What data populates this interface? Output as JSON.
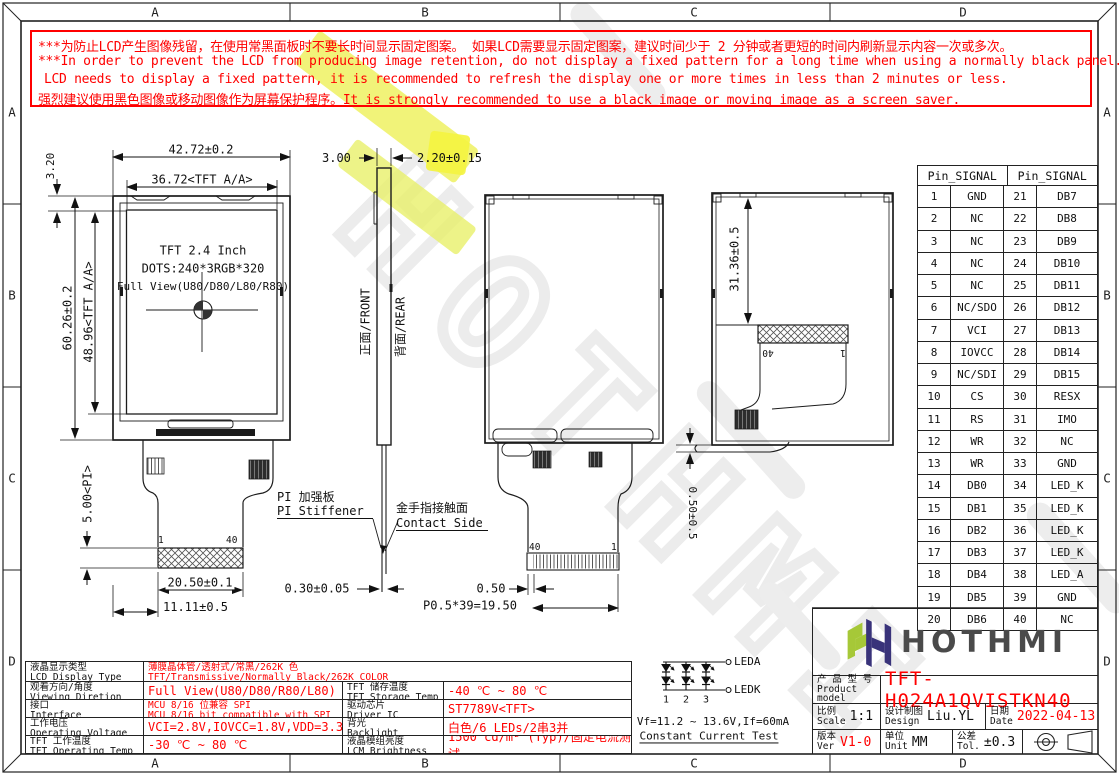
{
  "frame": {
    "zones": [
      "A",
      "B",
      "C",
      "D"
    ]
  },
  "warning": {
    "line1": "***为防止LCD产生图像残留，在使用常黑面板时不要长时间显示固定图案。 如果LCD需要显示固定图案，建议时间少于 2 分钟或者更短的时间内刷新显示内容一次或多次。",
    "line2": "***In order to prevent the LCD from producing image retention, do not display a fixed pattern for a long time when using a normally black panel. If the",
    "line3": "LCD needs to display a fixed pattern, it is recommended to refresh the display one or more times in less than 2 minutes or less.",
    "line4_zh": "强烈建议使用黑色图像或移动图像作为屏幕保护程序。",
    "line4_en": "It is strongly recommended to use a black image or moving image as a screen saver."
  },
  "fv": {
    "l1": "TFT 2.4 Inch",
    "l2": "DOTS:240*3RGB*320",
    "l3": "Full View(U80/D80/L80/R80)",
    "w": "42.72±0.2",
    "wa": "36.72<TFT A/A>",
    "off": "3.20",
    "h": "60.26±0.2",
    "ha": "48.96<TFT A/A>",
    "pi": "5.00<PI>",
    "cw": "20.50±0.1",
    "co": "11.11±0.5",
    "p1": "1",
    "p40": "40"
  },
  "sv": {
    "t1": "3.00",
    "t2": "2.20±0.15",
    "front": "正面/FRONT",
    "rear": "背面/REAR",
    "stiff_zh": "PI 加强板",
    "stiff_en": "PI Stiffener",
    "contact_zh": "金手指接触面",
    "contact_en": "Contact Side",
    "ft": "0.30±0.05",
    "fo": "0.50",
    "pitch": "P0.5*39=19.50",
    "p40": "40",
    "p1": "1"
  },
  "bv": {
    "cp": "31.36±0.5",
    "pr": "0.50±0.5",
    "p40": "40",
    "p1": "1"
  },
  "pin_table": {
    "header": "Pin_SIGNAL",
    "rows": [
      [
        "1",
        "GND",
        "21",
        "DB7"
      ],
      [
        "2",
        "NC",
        "22",
        "DB8"
      ],
      [
        "3",
        "NC",
        "23",
        "DB9"
      ],
      [
        "4",
        "NC",
        "24",
        "DB10"
      ],
      [
        "5",
        "NC",
        "25",
        "DB11"
      ],
      [
        "6",
        "NC/SDO",
        "26",
        "DB12"
      ],
      [
        "7",
        "VCI",
        "27",
        "DB13"
      ],
      [
        "8",
        "IOVCC",
        "28",
        "DB14"
      ],
      [
        "9",
        "NC/SDI",
        "29",
        "DB15"
      ],
      [
        "10",
        "CS",
        "30",
        "RESX"
      ],
      [
        "11",
        "RS",
        "31",
        "IMO"
      ],
      [
        "12",
        "WR",
        "32",
        "NC"
      ],
      [
        "13",
        "WR",
        "33",
        "GND"
      ],
      [
        "14",
        "DB0",
        "34",
        "LED_K"
      ],
      [
        "15",
        "DB1",
        "35",
        "LED_K"
      ],
      [
        "16",
        "DB2",
        "36",
        "LED_K"
      ],
      [
        "17",
        "DB3",
        "37",
        "LED_K"
      ],
      [
        "18",
        "DB4",
        "38",
        "LED_A"
      ],
      [
        "19",
        "DB5",
        "39",
        "GND"
      ],
      [
        "20",
        "DB6",
        "40",
        "NC"
      ]
    ]
  },
  "spec_table": {
    "rows": [
      {
        "label_zh": "液晶显示类型",
        "label_en": "LCD Display Type",
        "span": true,
        "value_lines": [
          "薄膜晶体管/透射式/常黑/262K 色",
          "TFT/Transmissive/Normally Black/262K COLOR"
        ]
      },
      {
        "label_zh": "观看方向/角度",
        "label_en": "Viewing Diretion",
        "value_lines": [
          "Full View(U80/D80/R80/L80)"
        ],
        "label2_zh": "TFT 储存温度",
        "label2_en": "TFT Storage Temp",
        "value2_lines": [
          "-40 ℃ ~ 80 ℃"
        ]
      },
      {
        "label_zh": "接口",
        "label_en": "Interface",
        "value_lines": [
          "MCU 8/16 位兼容 SPI",
          "MCU 8/16 bit compatible with SPI"
        ],
        "label2_zh": "驱动芯片",
        "label2_en": "Driver IC",
        "value2_lines": [
          "ST7789V<TFT>"
        ]
      },
      {
        "label_zh": "工作电压",
        "label_en": "Operating Voltage",
        "value_lines": [
          "VCI=2.8V,IOVCC=1.8V,VDD=3.3V(Typ)"
        ],
        "label2_zh": "背光",
        "label2_en": "Backlight",
        "value2_lines": [
          "白色/6 LEDs/2串3并"
        ]
      },
      {
        "label_zh": "TFT 工作温度",
        "label_en": "TFT Operating Temp",
        "value_lines": [
          "-30 ℃ ~ 80 ℃"
        ],
        "label2_zh": "液晶模组亮度",
        "label2_en": "LCM Brightness",
        "value2_lines": [
          "1500 cd/m² (Typ)/固定电流测试"
        ]
      }
    ]
  },
  "led_circuit": {
    "terminal_top": "LEDA",
    "terminal_bottom": "LEDK",
    "columns": [
      "1",
      "2",
      "3"
    ],
    "spec": "Vf=11.2 ~ 13.6V,If=60mA",
    "note": "Constant Current Test"
  },
  "title_block": {
    "brand": "HOTHMI",
    "product_label_zh": "产 品 型 号",
    "product_label_en": "Product model",
    "product_model": "TFT-H024A1QVISTKN40",
    "scale_zh": "比例",
    "scale_en": "Scale",
    "scale_value": "1:1",
    "design_zh": "设计制图",
    "design_en": "Design",
    "design_value": "Liu.YL",
    "date_zh": "日期",
    "date_en": "Date",
    "date_value": "2022-04-13",
    "ver_zh": "版本",
    "ver_en": "Ver",
    "ver_value": "V1-0",
    "unit_zh": "单位",
    "unit_en": "Unit",
    "unit_value": "MM",
    "tol_zh": "公差",
    "tol_en": "Tol.",
    "tol_value": "±0.3"
  },
  "watermark": "HOTHMI",
  "colors": {
    "accent_red": "#ff0000",
    "line": "#1c1c1c",
    "logo_green": "#a6c838",
    "logo_navy": "#39337a",
    "watermark_gray": "#ececec",
    "highlight_yellow": "#eff161"
  }
}
